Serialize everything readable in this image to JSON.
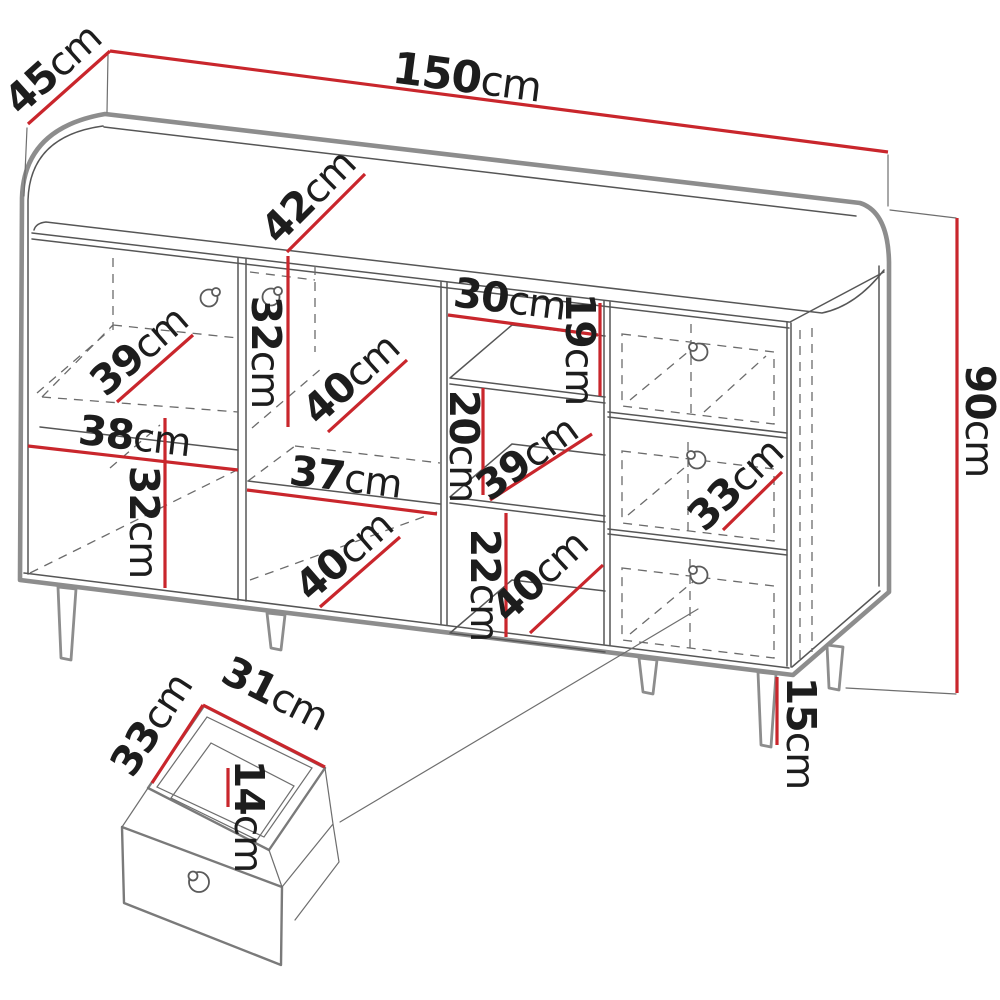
{
  "diagram": {
    "unit": "cm",
    "colors": {
      "dimension_red": "#c9262c",
      "outline_gray": "#8d8d8d",
      "text_black": "#1d1d1d"
    },
    "main_view": {
      "width": {
        "v": "150",
        "u": "cm"
      },
      "depth": {
        "v": "45",
        "u": "cm"
      },
      "height": {
        "v": "90",
        "u": "cm"
      },
      "leg_height": {
        "v": "15",
        "u": "cm"
      },
      "top_recess_depth": {
        "v": "42",
        "u": "cm"
      },
      "left_door": {
        "shelf_depth": {
          "v": "39",
          "u": "cm"
        },
        "shelf_width": {
          "v": "38",
          "u": "cm"
        },
        "lower_height": {
          "v": "32",
          "u": "cm"
        }
      },
      "middle_door": {
        "upper_height": {
          "v": "32",
          "u": "cm"
        },
        "upper_depth": {
          "v": "40",
          "u": "cm"
        },
        "shelf_width": {
          "v": "37",
          "u": "cm"
        },
        "lower_depth": {
          "v": "40",
          "u": "cm"
        }
      },
      "open_shelves": {
        "top_width": {
          "v": "30",
          "u": "cm"
        },
        "top_height": {
          "v": "19",
          "u": "cm"
        },
        "middle_height": {
          "v": "20",
          "u": "cm"
        },
        "middle_depth": {
          "v": "39",
          "u": "cm"
        },
        "bottom_height": {
          "v": "22",
          "u": "cm"
        },
        "bottom_depth": {
          "v": "40",
          "u": "cm"
        }
      },
      "drawers": {
        "width": {
          "v": "33",
          "u": "cm"
        }
      }
    },
    "drawer_detail": {
      "width": {
        "v": "31",
        "u": "cm"
      },
      "depth": {
        "v": "33",
        "u": "cm"
      },
      "height": {
        "v": "14",
        "u": "cm"
      }
    }
  }
}
